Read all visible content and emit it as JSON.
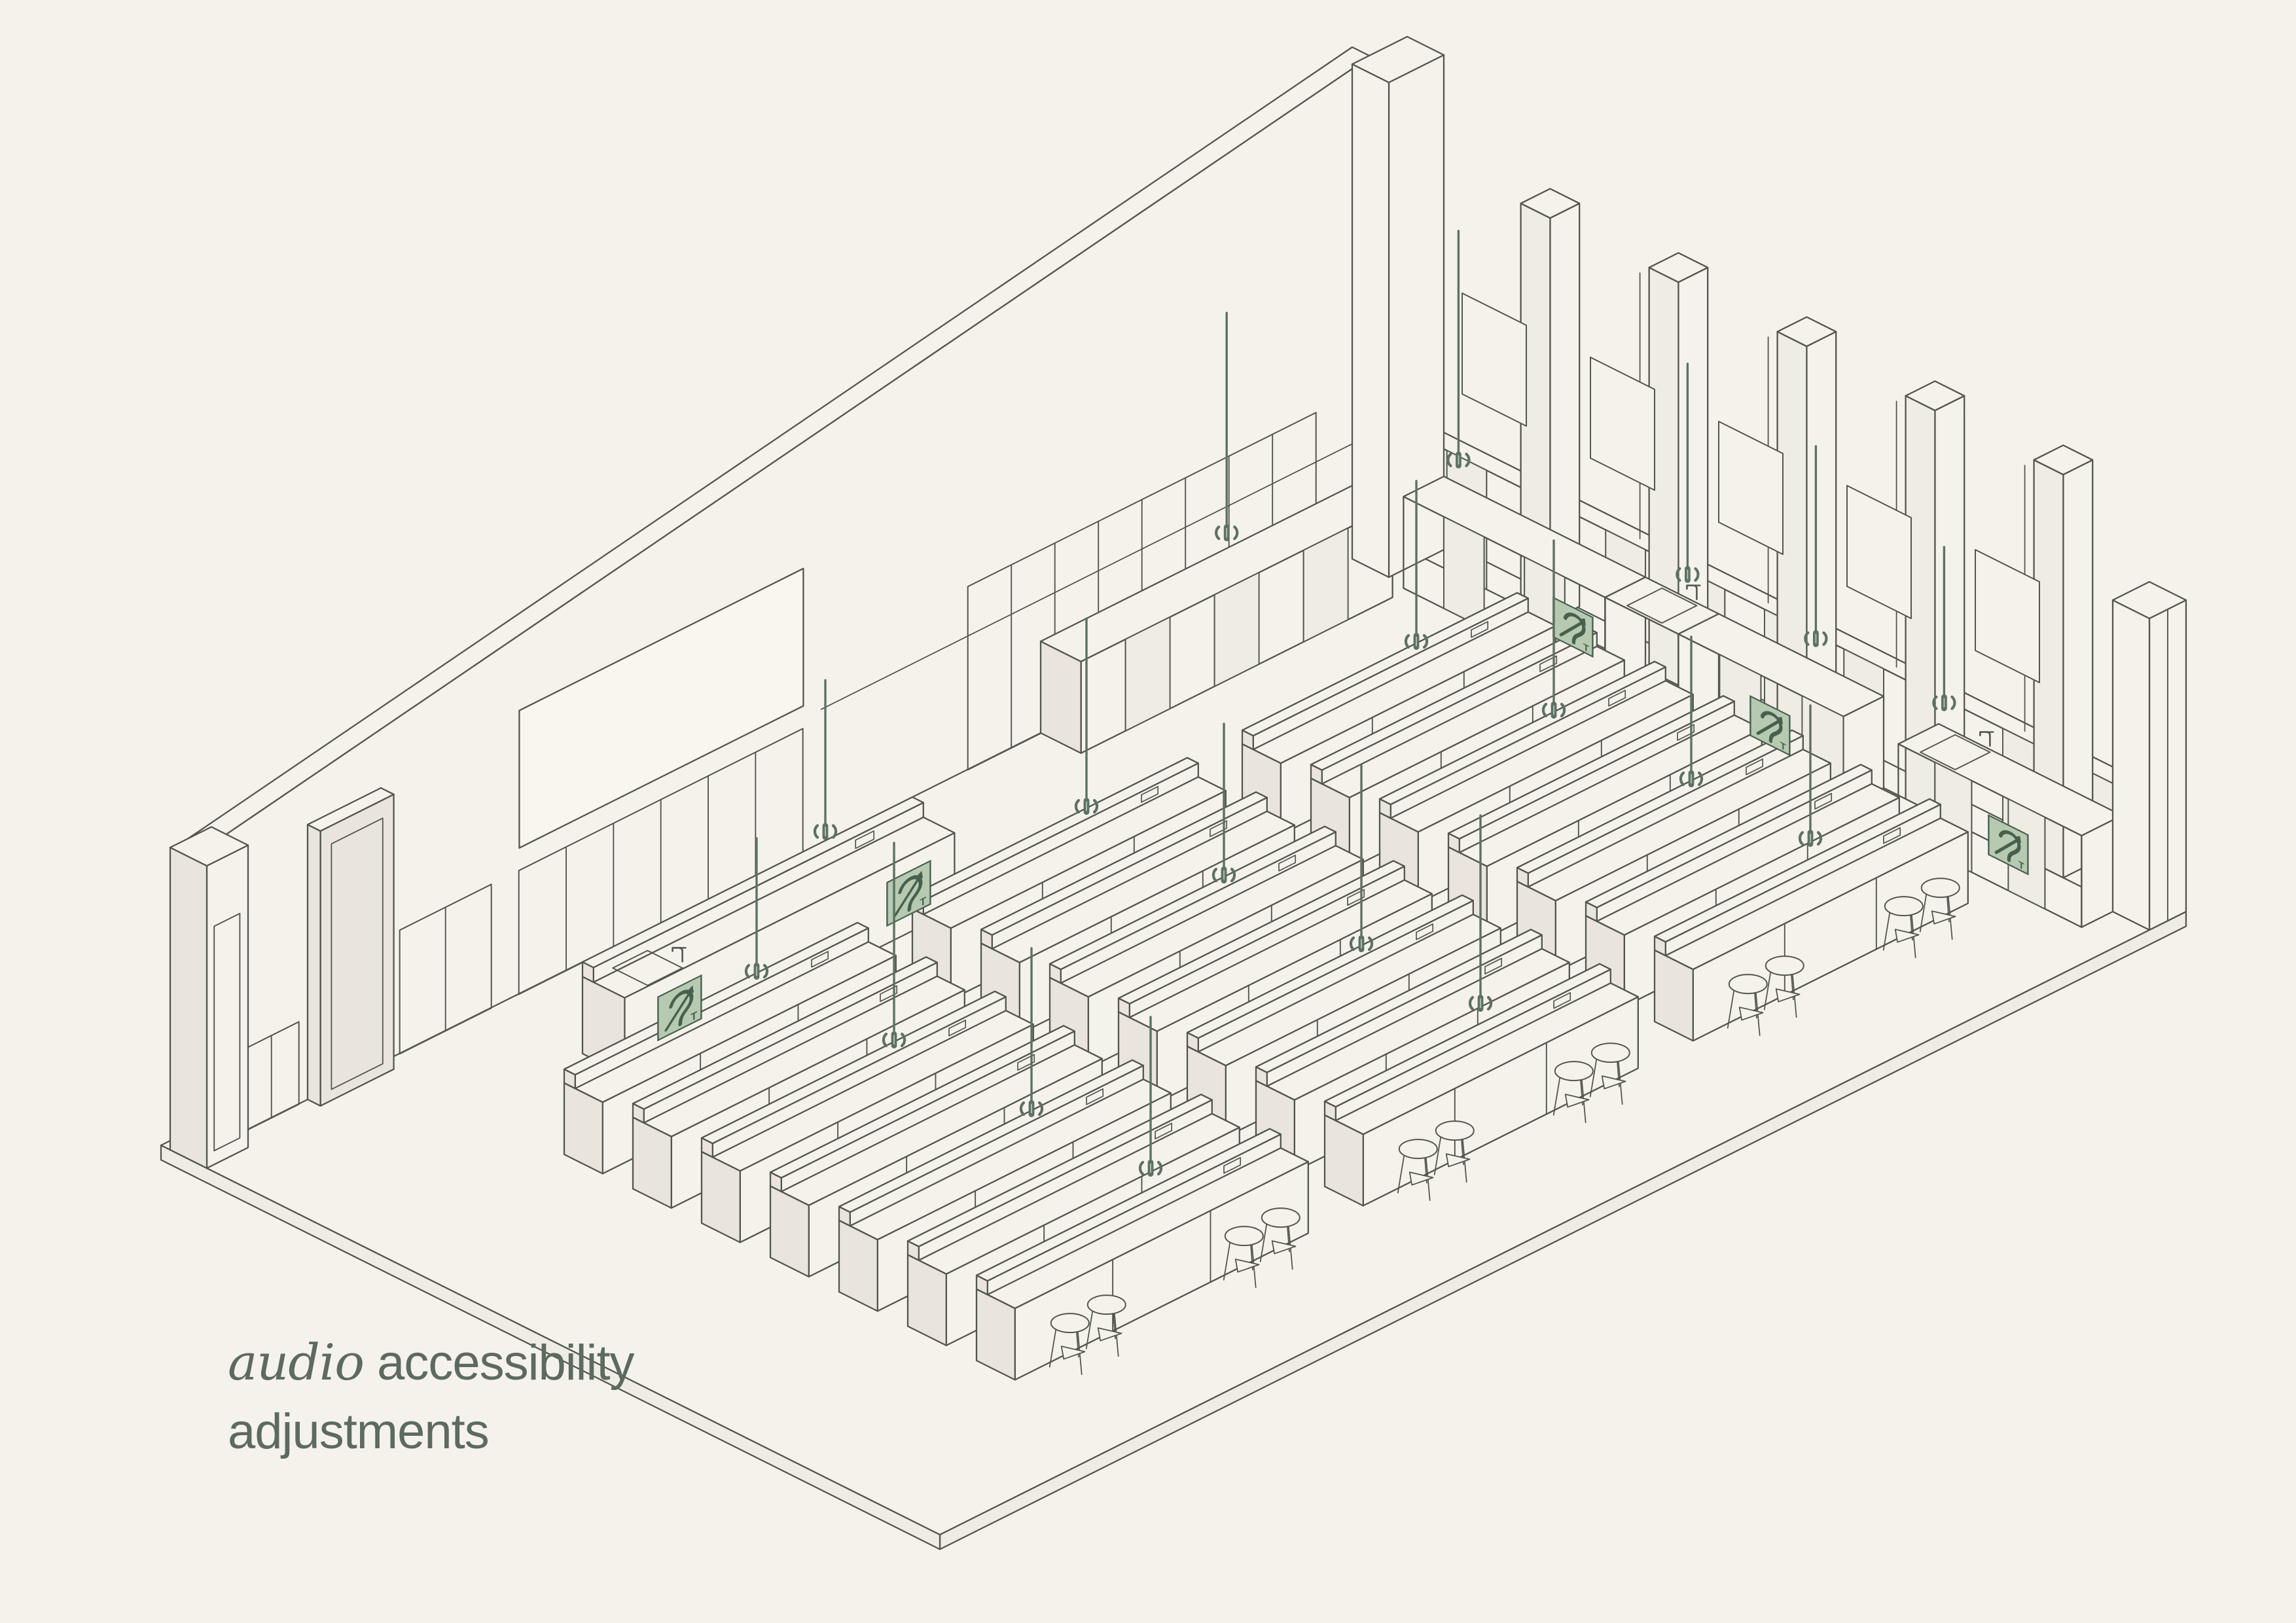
{
  "title": {
    "line1_italic": "audio",
    "line1_rest": " accessibility",
    "line2": "adjustments",
    "color": "#5d6b5f"
  },
  "palette": {
    "background": "#f5f2ec",
    "line": "#53564c",
    "face_shade": "#e9e5dd",
    "face_light": "#efece4",
    "board_fill": "#f8f6ef",
    "accent_green": "#5d7261",
    "accent_green_dark": "#47604e",
    "sign_bg": "#b7c9b1",
    "mic_slit": "#b9c7b7"
  },
  "scene": {
    "description": "Isometric line drawing of a lecture laboratory classroom fitted with audio accessibility equipment: hanging microphones over bench rows, hearing-loop signs on the demonstration bench and wall cabinets, whiteboard, wainscot panels, window pillars and stools.",
    "sign_letter": "T",
    "room": {
      "length_units": 131,
      "depth_units": 80,
      "wall_height_left": 33,
      "wall_height_right": 56
    },
    "bench_rows": {
      "count": 7,
      "segments_per_row": 3,
      "stools_per_segment": 4
    },
    "demo_bench": {
      "hearing_loop_signs": 2,
      "taps": 1
    },
    "equipment": {
      "hanging_microphones": 18,
      "hearing_loop_signs": 5,
      "sinks": 3,
      "whiteboards": 1,
      "doors": 2,
      "window_pillars": 5
    },
    "icons": [
      "hanging-microphone-icon",
      "sound-wave-icon",
      "hearing-loop-sign-icon",
      "tap-icon"
    ]
  }
}
